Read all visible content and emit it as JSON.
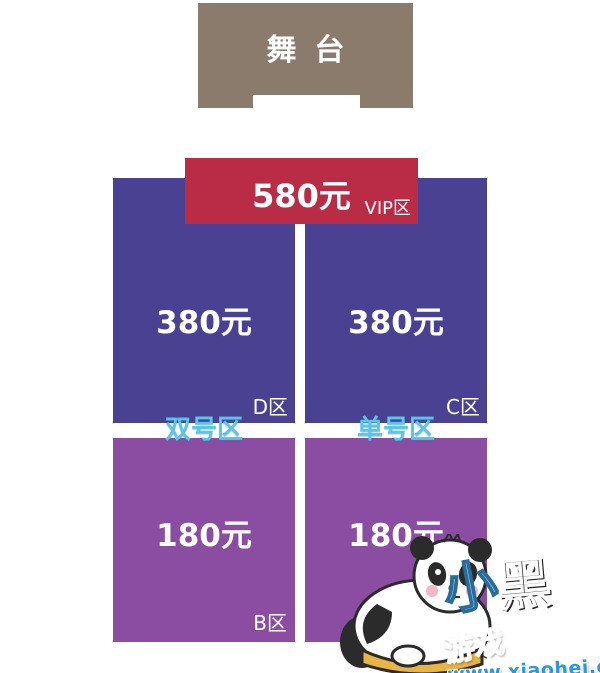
{
  "stage": {
    "label": "舞台"
  },
  "zones": {
    "vip": {
      "price": "580元",
      "label": "VIP区"
    },
    "d": {
      "price": "380元",
      "label": "D区"
    },
    "c": {
      "price": "380元",
      "label": "C区"
    },
    "b": {
      "price": "180元",
      "label": "B区"
    },
    "a": {
      "price": "180元",
      "label": "A区"
    }
  },
  "group_labels": {
    "even": "双号区",
    "odd": "单号区"
  },
  "footnote": {
    "prefix": "座位",
    "mid": "406",
    "suffix": "个"
  },
  "watermark": {
    "xiao": "小",
    "hei": "黑",
    "youxi": "游戏",
    "url": "www.xiaohei.com"
  },
  "colors": {
    "stage": "#8b7b6d",
    "vip_banner": "#ba2c46",
    "tier_380": "#4a4193",
    "tier_180": "#8a4da1",
    "group_label": "#5bc4e9",
    "price_text": "#ffffff",
    "footnote_text": "#3b3b3b",
    "watermark_url": "#2d98d7",
    "background": "#ffffff"
  }
}
